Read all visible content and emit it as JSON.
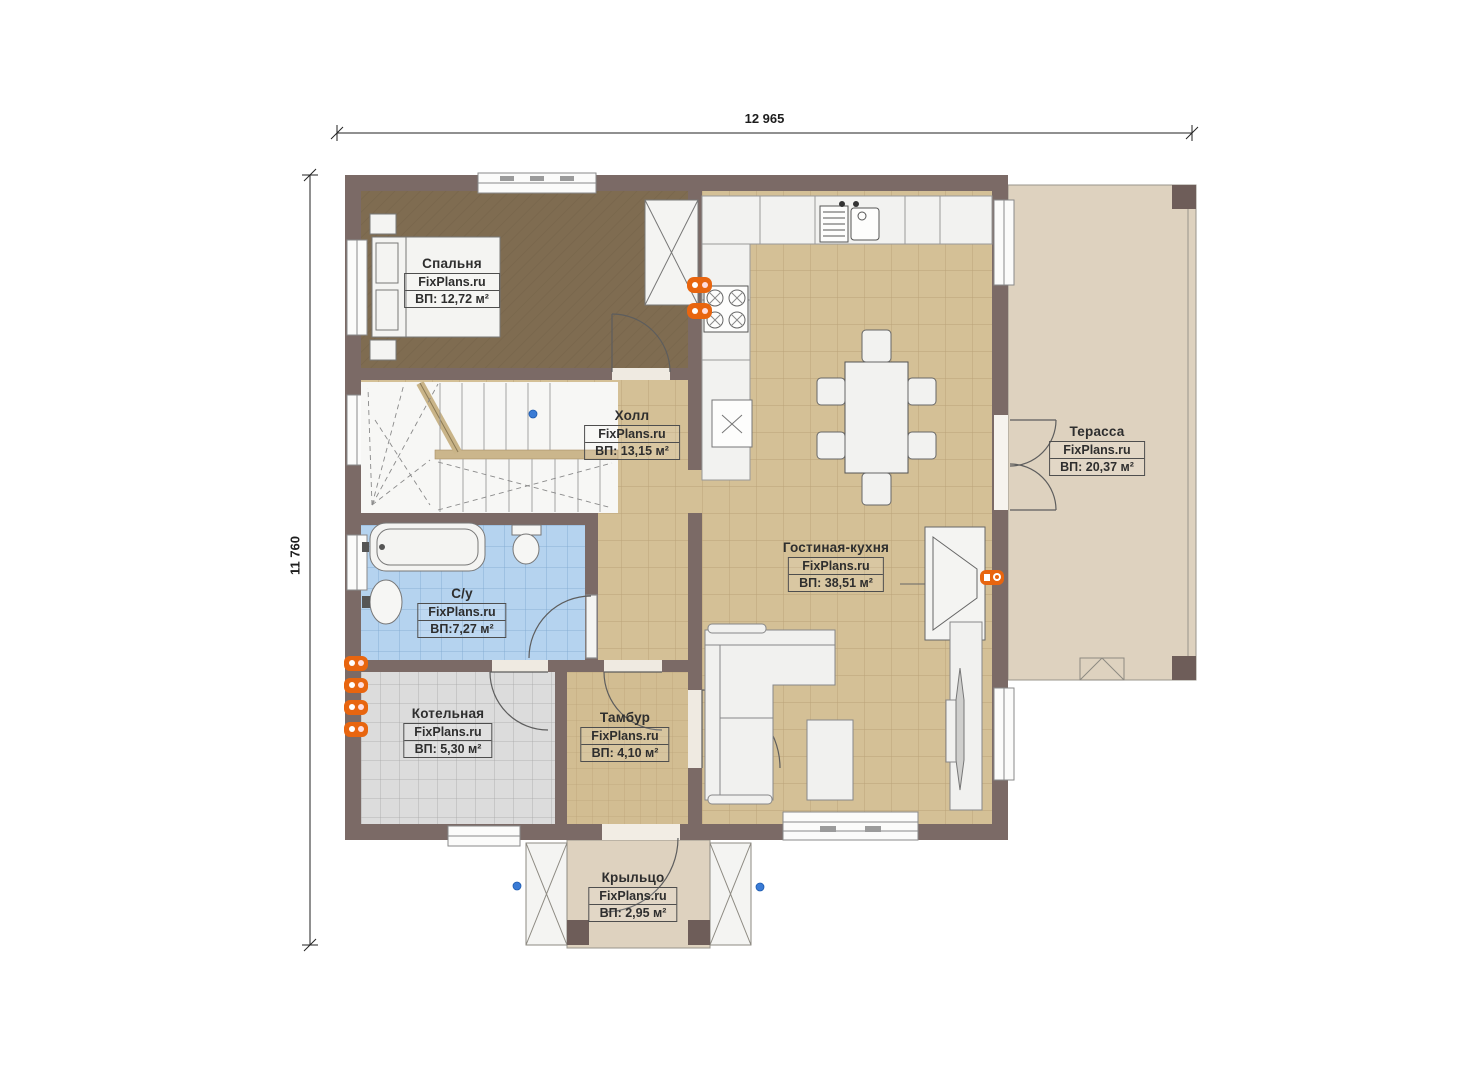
{
  "plan": {
    "type": "floor-plan",
    "brand": "FixPlans.ru",
    "dimensions": {
      "width_label": "12 965",
      "height_label": "11 760"
    },
    "rooms": [
      {
        "id": "bedroom",
        "name": "Спальня",
        "area": "ВП: 12,72 м²"
      },
      {
        "id": "hall",
        "name": "Холл",
        "area": "ВП: 13,15 м²"
      },
      {
        "id": "bathroom",
        "name": "С/у",
        "area": "ВП:7,27 м²"
      },
      {
        "id": "boiler-room",
        "name": "Котельная",
        "area": "ВП: 5,30 м²"
      },
      {
        "id": "vestibule",
        "name": "Тамбур",
        "area": "ВП: 4,10 м²"
      },
      {
        "id": "living-kitchen",
        "name": "Гостиная-кухня",
        "area": "ВП: 38,51 м²"
      },
      {
        "id": "terrace",
        "name": "Терасса",
        "area": "ВП: 20,37 м²"
      },
      {
        "id": "porch",
        "name": "Крыльцо",
        "area": "ВП: 2,95 м²"
      }
    ],
    "colors": {
      "wall": "#7b6a66",
      "bedroom_floor": "#7f6c51",
      "tan_tile": "#d4c096",
      "blue_tile": "#b5d3ef",
      "gray_tile": "#dcdcdc",
      "beige": "#ded2bf",
      "fixture_white": "#f2f2f0",
      "socket_orange": "#e8650f",
      "handle_blue": "#3a7bd5"
    }
  }
}
